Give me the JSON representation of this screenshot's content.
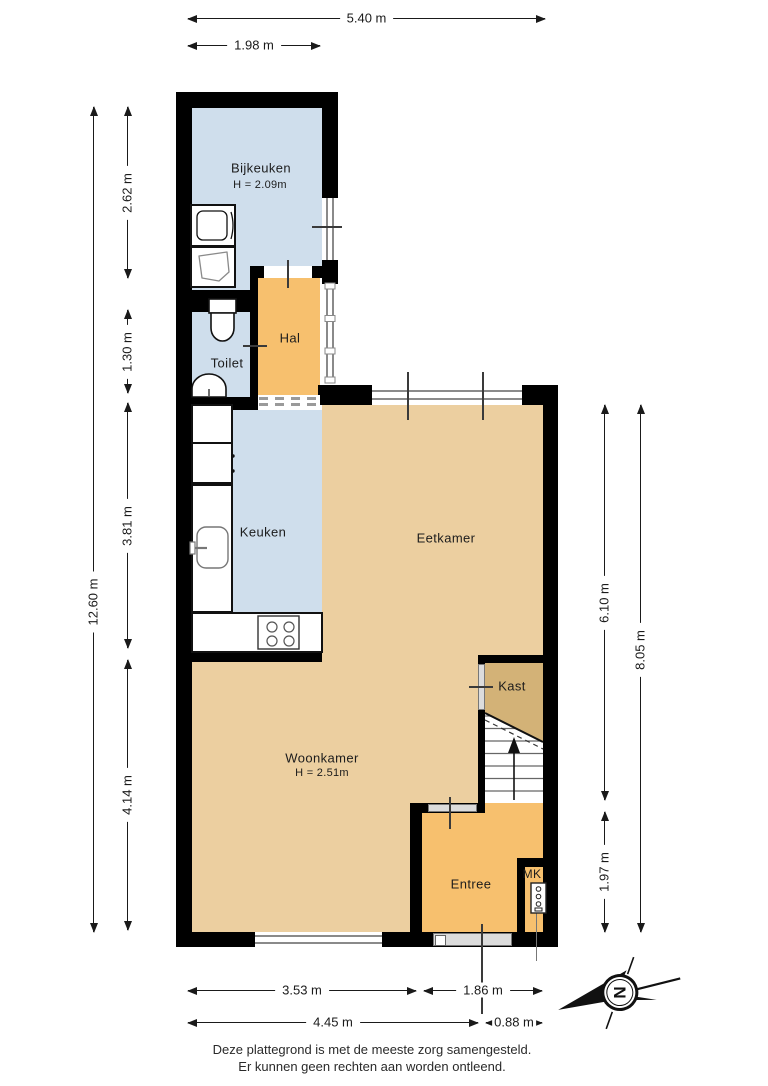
{
  "rooms": {
    "bijkeuken": {
      "name": "Bijkeuken",
      "height": "H = 2.09m"
    },
    "toilet": {
      "name": "Toilet"
    },
    "hal": {
      "name": "Hal"
    },
    "keuken": {
      "name": "Keuken"
    },
    "eetkamer": {
      "name": "Eetkamer"
    },
    "kast": {
      "name": "Kast"
    },
    "woonkamer": {
      "name": "Woonkamer",
      "height": "H = 2.51m"
    },
    "entree": {
      "name": "Entree"
    },
    "mk": {
      "name": "MK"
    }
  },
  "dims": {
    "top_total": "5.40 m",
    "top_annex": "1.98 m",
    "left_total": "12.60 m",
    "left_bijkeuken": "2.62 m",
    "left_toilet": "1.30 m",
    "left_keuken": "3.81 m",
    "left_woonkamer": "4.14 m",
    "right_eetkamer": "6.10 m",
    "right_entree": "1.97 m",
    "right_total": "8.05 m",
    "bottom_woonkamer": "3.53 m",
    "bottom_entree": "1.86 m",
    "bottom_total": "4.45 m",
    "bottom_door": "0.88 m"
  },
  "compass": {
    "north": "N"
  },
  "footer": {
    "line1": "Deze plattegrond is met de meeste zorg samengesteld.",
    "line2": "Er kunnen geen rechten aan worden ontleend."
  },
  "colors": {
    "wall": "#000000",
    "wet_rooms": "#cfdeec",
    "living": "#eccfa0",
    "hall": "#f7c06e",
    "closet": "#d3b277"
  }
}
